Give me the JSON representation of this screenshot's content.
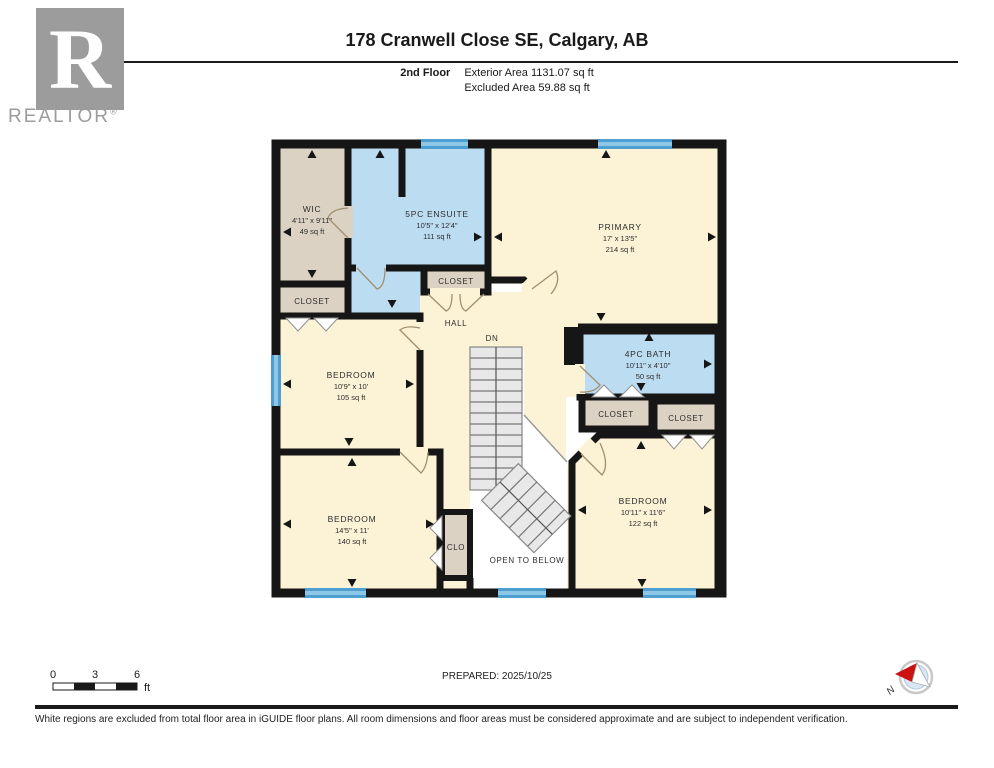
{
  "header": {
    "logo_letter": "R",
    "logo_brand": "REALTOR",
    "logo_reg": "®",
    "title": "178 Cranwell Close SE, Calgary, AB",
    "floor_label": "2nd Floor",
    "exterior_area": "Exterior Area 1131.07 sq ft",
    "excluded_area": "Excluded Area 59.88 sq ft"
  },
  "plan": {
    "colors": {
      "wall": "#161616",
      "room_cream": "#fcf2d5",
      "room_tan": "#dcd2c3",
      "room_blue": "#bcdcf2",
      "window": "#4d9fd2",
      "excluded_white": "#ffffff",
      "stairs": "#e8e8e8"
    },
    "rooms": {
      "wic": {
        "name": "WIC",
        "dims": "4'11\" x 9'11\"",
        "area": "49 sq ft"
      },
      "ensuite": {
        "name": "5PC ENSUITE",
        "dims": "10'5\" x 12'4\"",
        "area": "111 sq ft"
      },
      "primary": {
        "name": "PRIMARY",
        "dims": "17' x 13'5\"",
        "area": "214 sq ft"
      },
      "bath": {
        "name": "4PC BATH",
        "dims": "10'11\" x 4'10\"",
        "area": "50 sq ft"
      },
      "bedroom_mid_left": {
        "name": "BEDROOM",
        "dims": "10'9\" x 10'",
        "area": "105 sq ft"
      },
      "bedroom_bottom_left": {
        "name": "BEDROOM",
        "dims": "14'5\" x 11'",
        "area": "140 sq ft"
      },
      "bedroom_bottom_right": {
        "name": "BEDROOM",
        "dims": "10'11\" x 11'6\"",
        "area": "122 sq ft"
      }
    },
    "labels": {
      "closet_wic": "CLOSET",
      "closet_hall": "CLOSET",
      "closet_bath_left": "CLOSET",
      "closet_bath_right": "CLOSET",
      "clo": "CLO",
      "hall": "HALL",
      "dn": "DN",
      "open_to_below": "OPEN TO BELOW"
    }
  },
  "footer": {
    "scale": {
      "t0": "0",
      "t3": "3",
      "t6": "6",
      "unit": "ft"
    },
    "prepared": "PREPARED: 2025/10/25",
    "compass_n": "N",
    "disclaimer": "White regions are excluded from total floor area in iGUIDE floor plans. All room dimensions and floor areas must be considered approximate and are subject to independent verification."
  }
}
